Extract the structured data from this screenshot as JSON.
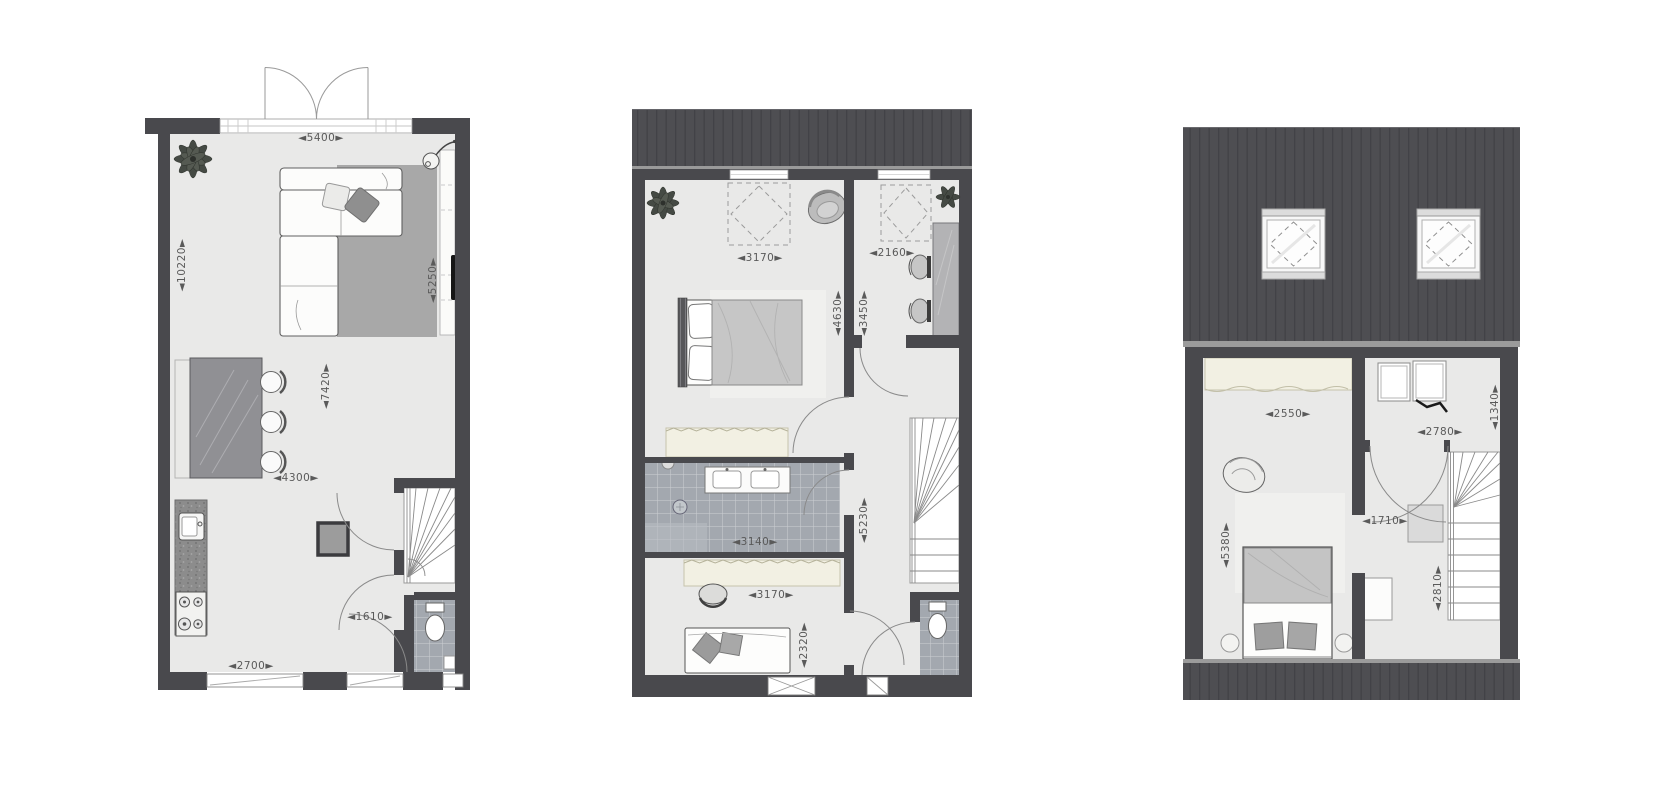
{
  "page": {
    "background": "#ffffff",
    "type": "architectural-floor-plans",
    "plan_count": "3"
  },
  "colors": {
    "wall": "#49494d",
    "roof": "#4e4e52",
    "floor": "#e9e9e8",
    "tile": "#a3a8af",
    "rug": "#a8a8a8",
    "cream_furniture": "#f2f0e3",
    "dimension_text": "#5a5a5a"
  },
  "plans": [
    {
      "id": "ground-floor",
      "dims": {
        "d5400": "◄5400►",
        "d10220": "◄10220►",
        "d5250": "◄5250►",
        "d7420": "◄7420►",
        "d4300": "◄4300►",
        "d1610": "◄1610►",
        "d2700": "◄2700►"
      },
      "furniture": [
        "plant",
        "floor-lamp",
        "corner-sofa",
        "rug",
        "tv",
        "sideboard",
        "dining-table",
        "dining-chairs",
        "bench",
        "kitchen-counter",
        "sink",
        "stove",
        "stairs",
        "toilet",
        "french-doors",
        "windows"
      ]
    },
    {
      "id": "first-floor",
      "dims": {
        "d3170_top": "◄3170►",
        "d2160": "◄2160►",
        "d4630": "◄4630►",
        "d3450": "◄3450►",
        "d3140": "◄3140►",
        "d5230": "◄5230►",
        "d3170_bottom": "◄3170►",
        "d2320": "◄2320►"
      },
      "furniture": [
        "plant",
        "skylight",
        "armchair",
        "double-bed",
        "wardrobe",
        "desk",
        "office-chairs",
        "bathroom-vanity",
        "shower",
        "stairs",
        "toilet",
        "single-bed",
        "desk-chair",
        "windows"
      ]
    },
    {
      "id": "attic-floor",
      "dims": {
        "d2550": "◄2550►",
        "d2780": "◄2780►",
        "d1340": "◄1340►",
        "d1710": "◄1710►",
        "d5380": "◄5380►",
        "d2810": "◄2810►"
      },
      "furniture": [
        "roof-skylights",
        "wardrobe",
        "armchair",
        "double-bed",
        "washer",
        "dryer",
        "stairs",
        "cabinet"
      ]
    }
  ]
}
